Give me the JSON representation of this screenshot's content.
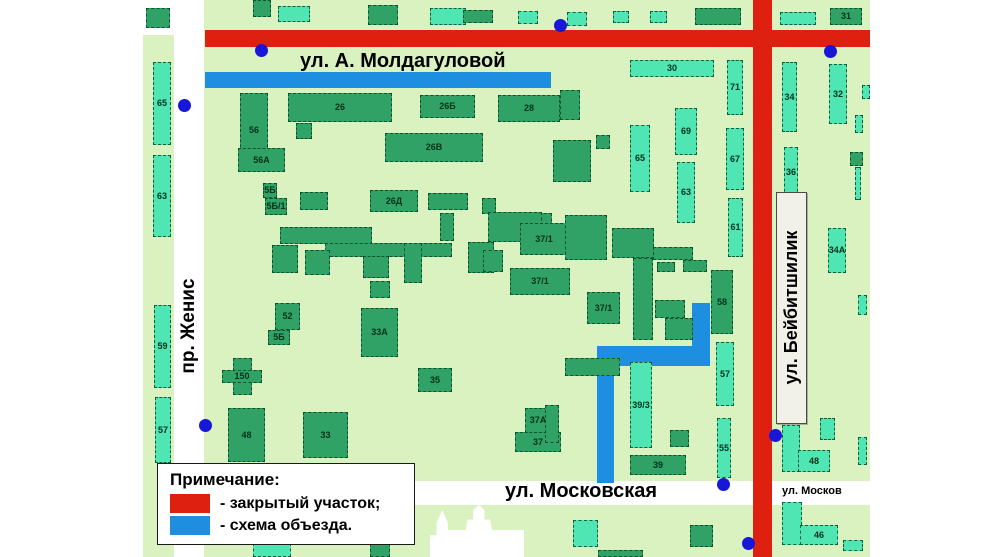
{
  "streets": {
    "moldagulova": "ул. А. Молдагуловой",
    "zhenis": "пр. Женис",
    "beybitshilik": "ул. Бейбитшилик",
    "moskovskaya": "ул. Московская",
    "moskovskaya_right": "ул. Москов"
  },
  "legend": {
    "title": "Примечание:",
    "items": [
      {
        "color": "#dd2010",
        "label": "- закрытый участок;"
      },
      {
        "color": "#1e8fe0",
        "label": "- схема объезда."
      }
    ]
  },
  "colors": {
    "map_background": "#d9f2c0",
    "closed_section": "#dd2010",
    "detour_route": "#1e8fe0",
    "building_dark": "#31a265",
    "building_light": "#4fe6b4",
    "stop_dot": "#1717d8"
  },
  "map": {
    "closed_segments": [
      {
        "x": 205,
        "y": 30,
        "w": 665,
        "h": 17
      },
      {
        "x": 753,
        "y": 0,
        "w": 19,
        "h": 557
      }
    ],
    "detour_segments": [
      {
        "x": 205,
        "y": 72,
        "w": 346,
        "h": 16
      },
      {
        "x": 692,
        "y": 303,
        "w": 18,
        "h": 60
      },
      {
        "x": 597,
        "y": 346,
        "w": 113,
        "h": 20
      },
      {
        "x": 597,
        "y": 346,
        "w": 17,
        "h": 137
      }
    ],
    "dots": [
      {
        "x": 184,
        "y": 105
      },
      {
        "x": 261,
        "y": 50
      },
      {
        "x": 560,
        "y": 25
      },
      {
        "x": 830,
        "y": 51
      },
      {
        "x": 205,
        "y": 425
      },
      {
        "x": 775,
        "y": 435
      },
      {
        "x": 723,
        "y": 484
      },
      {
        "x": 748,
        "y": 543
      }
    ],
    "buildings": [
      {
        "x": 146,
        "y": 8,
        "w": 24,
        "h": 20,
        "label": "",
        "shade": "dark"
      },
      {
        "x": 153,
        "y": 62,
        "w": 18,
        "h": 83,
        "label": "65",
        "shade": "teal"
      },
      {
        "x": 153,
        "y": 155,
        "w": 18,
        "h": 82,
        "label": "63",
        "shade": "teal"
      },
      {
        "x": 154,
        "y": 305,
        "w": 17,
        "h": 83,
        "label": "59",
        "shade": "teal"
      },
      {
        "x": 155,
        "y": 397,
        "w": 16,
        "h": 66,
        "label": "57",
        "shade": "teal"
      },
      {
        "x": 253,
        "y": 0,
        "w": 18,
        "h": 17,
        "label": "",
        "shade": "dark"
      },
      {
        "x": 278,
        "y": 6,
        "w": 32,
        "h": 16,
        "label": "",
        "shade": "teal"
      },
      {
        "x": 368,
        "y": 5,
        "w": 30,
        "h": 20,
        "label": "",
        "shade": "dark"
      },
      {
        "x": 430,
        "y": 8,
        "w": 36,
        "h": 17,
        "label": "",
        "shade": "teal"
      },
      {
        "x": 463,
        "y": 10,
        "w": 30,
        "h": 13,
        "label": "",
        "shade": "dark"
      },
      {
        "x": 518,
        "y": 11,
        "w": 20,
        "h": 13,
        "label": "",
        "shade": "teal"
      },
      {
        "x": 567,
        "y": 12,
        "w": 20,
        "h": 14,
        "label": "",
        "shade": "teal"
      },
      {
        "x": 613,
        "y": 11,
        "w": 16,
        "h": 12,
        "label": "",
        "shade": "teal"
      },
      {
        "x": 650,
        "y": 11,
        "w": 17,
        "h": 12,
        "label": "",
        "shade": "teal"
      },
      {
        "x": 695,
        "y": 8,
        "w": 46,
        "h": 17,
        "label": "",
        "shade": "dark"
      },
      {
        "x": 780,
        "y": 12,
        "w": 36,
        "h": 13,
        "label": "",
        "shade": "teal"
      },
      {
        "x": 830,
        "y": 8,
        "w": 32,
        "h": 17,
        "label": "31",
        "shade": "dark"
      },
      {
        "x": 240,
        "y": 93,
        "w": 28,
        "h": 75,
        "label": "56",
        "shade": "dark"
      },
      {
        "x": 288,
        "y": 93,
        "w": 104,
        "h": 29,
        "label": "26",
        "shade": "dark"
      },
      {
        "x": 420,
        "y": 95,
        "w": 55,
        "h": 23,
        "label": "26Б",
        "shade": "dark"
      },
      {
        "x": 498,
        "y": 95,
        "w": 62,
        "h": 27,
        "label": "28",
        "shade": "dark"
      },
      {
        "x": 385,
        "y": 133,
        "w": 98,
        "h": 29,
        "label": "26В",
        "shade": "dark"
      },
      {
        "x": 238,
        "y": 148,
        "w": 47,
        "h": 24,
        "label": "56А",
        "shade": "dark"
      },
      {
        "x": 553,
        "y": 140,
        "w": 38,
        "h": 42,
        "label": "",
        "shade": "dark"
      },
      {
        "x": 596,
        "y": 135,
        "w": 14,
        "h": 14,
        "label": "",
        "shade": "dark"
      },
      {
        "x": 296,
        "y": 123,
        "w": 16,
        "h": 16,
        "label": "",
        "shade": "dark"
      },
      {
        "x": 560,
        "y": 90,
        "w": 20,
        "h": 30,
        "label": "",
        "shade": "dark"
      },
      {
        "x": 630,
        "y": 60,
        "w": 84,
        "h": 17,
        "label": "30",
        "shade": "teal"
      },
      {
        "x": 727,
        "y": 60,
        "w": 16,
        "h": 55,
        "label": "71",
        "shade": "teal"
      },
      {
        "x": 630,
        "y": 125,
        "w": 20,
        "h": 67,
        "label": "65",
        "shade": "teal"
      },
      {
        "x": 675,
        "y": 108,
        "w": 22,
        "h": 47,
        "label": "69",
        "shade": "teal"
      },
      {
        "x": 726,
        "y": 128,
        "w": 18,
        "h": 62,
        "label": "67",
        "shade": "teal"
      },
      {
        "x": 677,
        "y": 162,
        "w": 18,
        "h": 61,
        "label": "63",
        "shade": "teal"
      },
      {
        "x": 728,
        "y": 198,
        "w": 15,
        "h": 59,
        "label": "61",
        "shade": "teal"
      },
      {
        "x": 263,
        "y": 183,
        "w": 14,
        "h": 15,
        "label": "5Б",
        "shade": "dark"
      },
      {
        "x": 265,
        "y": 198,
        "w": 22,
        "h": 17,
        "label": "5Б/1",
        "shade": "dark"
      },
      {
        "x": 370,
        "y": 190,
        "w": 48,
        "h": 22,
        "label": "26Д",
        "shade": "dark"
      },
      {
        "x": 428,
        "y": 193,
        "w": 40,
        "h": 17,
        "label": "",
        "shade": "dark"
      },
      {
        "x": 482,
        "y": 198,
        "w": 14,
        "h": 16,
        "label": "",
        "shade": "dark"
      },
      {
        "x": 300,
        "y": 192,
        "w": 28,
        "h": 18,
        "label": "",
        "shade": "dark"
      },
      {
        "x": 280,
        "y": 227,
        "w": 92,
        "h": 17,
        "label": "",
        "shade": "dark"
      },
      {
        "x": 325,
        "y": 243,
        "w": 127,
        "h": 14,
        "label": "",
        "shade": "dark"
      },
      {
        "x": 272,
        "y": 245,
        "w": 26,
        "h": 28,
        "label": "",
        "shade": "dark"
      },
      {
        "x": 305,
        "y": 250,
        "w": 25,
        "h": 25,
        "label": "",
        "shade": "dark"
      },
      {
        "x": 363,
        "y": 256,
        "w": 26,
        "h": 22,
        "label": "",
        "shade": "dark"
      },
      {
        "x": 468,
        "y": 242,
        "w": 26,
        "h": 31,
        "label": "",
        "shade": "dark"
      },
      {
        "x": 370,
        "y": 281,
        "w": 20,
        "h": 17,
        "label": "",
        "shade": "dark"
      },
      {
        "x": 404,
        "y": 243,
        "w": 18,
        "h": 40,
        "label": "",
        "shade": "dark"
      },
      {
        "x": 440,
        "y": 213,
        "w": 14,
        "h": 28,
        "label": "",
        "shade": "dark"
      },
      {
        "x": 538,
        "y": 213,
        "w": 14,
        "h": 14,
        "label": "",
        "shade": "dark"
      },
      {
        "x": 488,
        "y": 212,
        "w": 54,
        "h": 30,
        "label": "",
        "shade": "dark"
      },
      {
        "x": 483,
        "y": 250,
        "w": 20,
        "h": 22,
        "label": "",
        "shade": "dark"
      },
      {
        "x": 520,
        "y": 223,
        "w": 48,
        "h": 32,
        "label": "37/1",
        "shade": "dark"
      },
      {
        "x": 510,
        "y": 268,
        "w": 60,
        "h": 27,
        "label": "37/1",
        "shade": "dark"
      },
      {
        "x": 587,
        "y": 292,
        "w": 33,
        "h": 32,
        "label": "37/1",
        "shade": "dark"
      },
      {
        "x": 565,
        "y": 215,
        "w": 42,
        "h": 45,
        "label": "",
        "shade": "dark"
      },
      {
        "x": 612,
        "y": 228,
        "w": 42,
        "h": 30,
        "label": "",
        "shade": "dark"
      },
      {
        "x": 653,
        "y": 247,
        "w": 40,
        "h": 13,
        "label": "",
        "shade": "dark"
      },
      {
        "x": 633,
        "y": 258,
        "w": 20,
        "h": 82,
        "label": "",
        "shade": "dark"
      },
      {
        "x": 657,
        "y": 262,
        "w": 18,
        "h": 10,
        "label": "",
        "shade": "dark"
      },
      {
        "x": 683,
        "y": 260,
        "w": 24,
        "h": 12,
        "label": "",
        "shade": "dark"
      },
      {
        "x": 655,
        "y": 300,
        "w": 30,
        "h": 18,
        "label": "",
        "shade": "dark"
      },
      {
        "x": 665,
        "y": 318,
        "w": 28,
        "h": 22,
        "label": "",
        "shade": "dark"
      },
      {
        "x": 711,
        "y": 270,
        "w": 22,
        "h": 64,
        "label": "58",
        "shade": "dark"
      },
      {
        "x": 716,
        "y": 342,
        "w": 18,
        "h": 64,
        "label": "57",
        "shade": "teal"
      },
      {
        "x": 717,
        "y": 418,
        "w": 14,
        "h": 60,
        "label": "55",
        "shade": "teal"
      },
      {
        "x": 361,
        "y": 308,
        "w": 37,
        "h": 49,
        "label": "33А",
        "shade": "dark"
      },
      {
        "x": 418,
        "y": 368,
        "w": 34,
        "h": 24,
        "label": "35",
        "shade": "dark"
      },
      {
        "x": 233,
        "y": 358,
        "w": 19,
        "h": 37,
        "label": "",
        "shade": "dark"
      },
      {
        "x": 222,
        "y": 370,
        "w": 40,
        "h": 13,
        "label": "150",
        "shade": "dark"
      },
      {
        "x": 275,
        "y": 303,
        "w": 25,
        "h": 27,
        "label": "52",
        "shade": "dark"
      },
      {
        "x": 268,
        "y": 330,
        "w": 22,
        "h": 15,
        "label": "5Б",
        "shade": "dark"
      },
      {
        "x": 228,
        "y": 408,
        "w": 37,
        "h": 54,
        "label": "48",
        "shade": "dark"
      },
      {
        "x": 303,
        "y": 412,
        "w": 45,
        "h": 46,
        "label": "33",
        "shade": "dark"
      },
      {
        "x": 525,
        "y": 408,
        "w": 26,
        "h": 25,
        "label": "37А",
        "shade": "dark"
      },
      {
        "x": 515,
        "y": 432,
        "w": 46,
        "h": 20,
        "label": "37",
        "shade": "dark"
      },
      {
        "x": 630,
        "y": 362,
        "w": 22,
        "h": 86,
        "label": "39/3",
        "shade": "teal"
      },
      {
        "x": 670,
        "y": 430,
        "w": 19,
        "h": 17,
        "label": "",
        "shade": "dark"
      },
      {
        "x": 630,
        "y": 455,
        "w": 56,
        "h": 20,
        "label": "39",
        "shade": "dark"
      },
      {
        "x": 565,
        "y": 358,
        "w": 55,
        "h": 18,
        "label": "",
        "shade": "dark"
      },
      {
        "x": 545,
        "y": 405,
        "w": 14,
        "h": 38,
        "label": "",
        "shade": "dark"
      },
      {
        "x": 573,
        "y": 520,
        "w": 25,
        "h": 27,
        "label": "",
        "shade": "teal"
      },
      {
        "x": 690,
        "y": 525,
        "w": 23,
        "h": 22,
        "label": "",
        "shade": "dark"
      },
      {
        "x": 253,
        "y": 543,
        "w": 38,
        "h": 14,
        "label": "",
        "shade": "teal"
      },
      {
        "x": 370,
        "y": 533,
        "w": 20,
        "h": 24,
        "label": "",
        "shade": "dark"
      },
      {
        "x": 598,
        "y": 550,
        "w": 45,
        "h": 7,
        "label": "",
        "shade": "dark"
      },
      {
        "x": 782,
        "y": 62,
        "w": 15,
        "h": 70,
        "label": "34",
        "shade": "teal"
      },
      {
        "x": 829,
        "y": 64,
        "w": 18,
        "h": 60,
        "label": "32",
        "shade": "teal"
      },
      {
        "x": 784,
        "y": 147,
        "w": 14,
        "h": 50,
        "label": "36",
        "shade": "teal"
      },
      {
        "x": 828,
        "y": 228,
        "w": 18,
        "h": 45,
        "label": "34А",
        "shade": "teal"
      },
      {
        "x": 782,
        "y": 425,
        "w": 18,
        "h": 47,
        "label": "",
        "shade": "teal"
      },
      {
        "x": 798,
        "y": 450,
        "w": 32,
        "h": 22,
        "label": "48",
        "shade": "teal"
      },
      {
        "x": 782,
        "y": 502,
        "w": 20,
        "h": 43,
        "label": "",
        "shade": "teal"
      },
      {
        "x": 800,
        "y": 525,
        "w": 38,
        "h": 20,
        "label": "46",
        "shade": "teal"
      },
      {
        "x": 820,
        "y": 418,
        "w": 15,
        "h": 22,
        "label": "",
        "shade": "teal"
      },
      {
        "x": 843,
        "y": 540,
        "w": 20,
        "h": 11,
        "label": "",
        "shade": "teal"
      },
      {
        "x": 855,
        "y": 115,
        "w": 8,
        "h": 18,
        "label": "",
        "shade": "teal"
      },
      {
        "x": 850,
        "y": 152,
        "w": 13,
        "h": 14,
        "label": "",
        "shade": "dark"
      },
      {
        "x": 855,
        "y": 167,
        "w": 6,
        "h": 33,
        "label": "",
        "shade": "teal"
      },
      {
        "x": 858,
        "y": 295,
        "w": 9,
        "h": 20,
        "label": "",
        "shade": "teal"
      },
      {
        "x": 858,
        "y": 437,
        "w": 9,
        "h": 28,
        "label": "",
        "shade": "teal"
      },
      {
        "x": 862,
        "y": 85,
        "w": 8,
        "h": 14,
        "label": "",
        "shade": "teal"
      }
    ]
  }
}
